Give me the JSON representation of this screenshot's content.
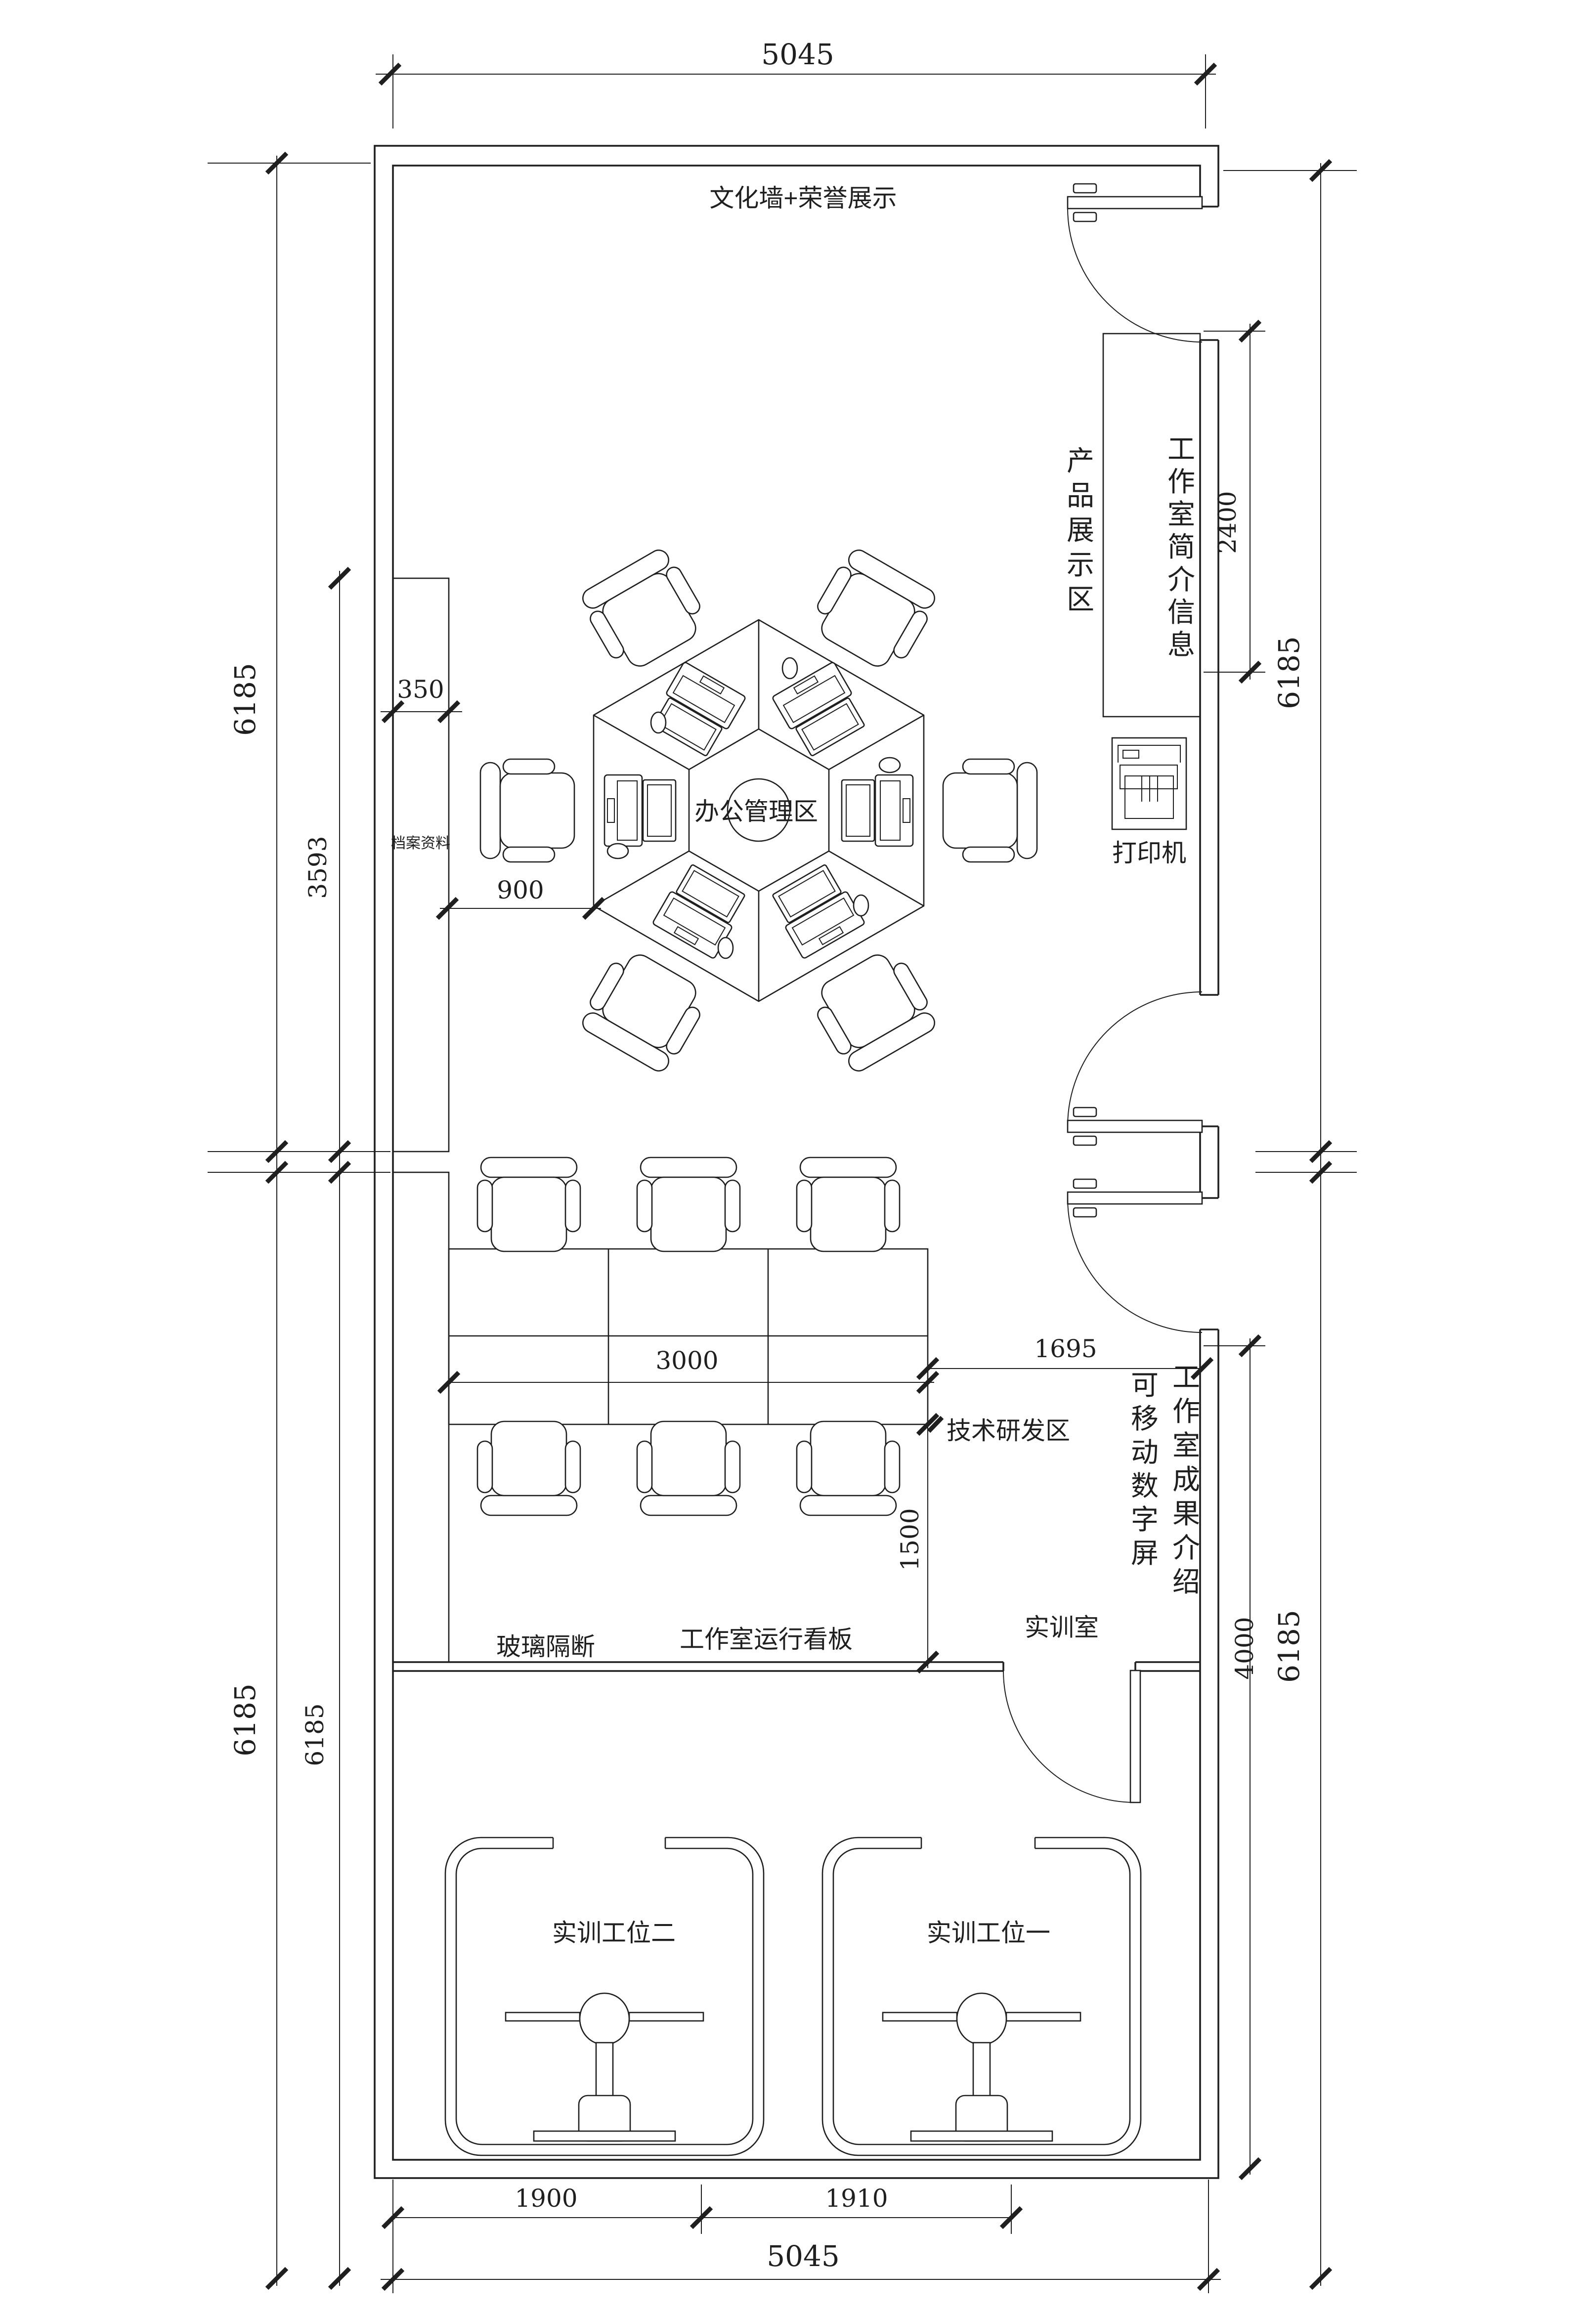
{
  "labels": {
    "culture_wall": "文化墙+荣誉展示",
    "product_display": "产品展示区",
    "studio_intro": "工作室简介信息",
    "office_admin": "办公管理区",
    "archive_cabinet": "档案资料",
    "printer": "打印机",
    "tech_rd": "技术研发区",
    "movable_screen": "可移动数字屏",
    "achievements": "工作室成果介绍",
    "glass_partition": "玻璃隔断",
    "operation_board": "工作室运行看板",
    "training_room": "实训室",
    "training_station_2": "实训工位二",
    "training_station_1": "实训工位一"
  },
  "dims": {
    "top": "5045",
    "bottom": "5045",
    "left_outer_upper": "6185",
    "left_inner_upper": "3593",
    "left_outer_lower": "6185",
    "left_inner_lower": "6185",
    "right_outer_upper": "6185",
    "right_inner_upper": "2400",
    "right_outer_lower": "6185",
    "right_inner_lower": "4000",
    "shelf_depth": "350",
    "shelf_offset": "900",
    "table_length": "3000",
    "opening_width": "1695",
    "rd_depth": "1500",
    "bay_left": "1900",
    "bay_right": "1910"
  },
  "colors": {
    "line": "#1f1f1f",
    "bg": "#ffffff"
  }
}
